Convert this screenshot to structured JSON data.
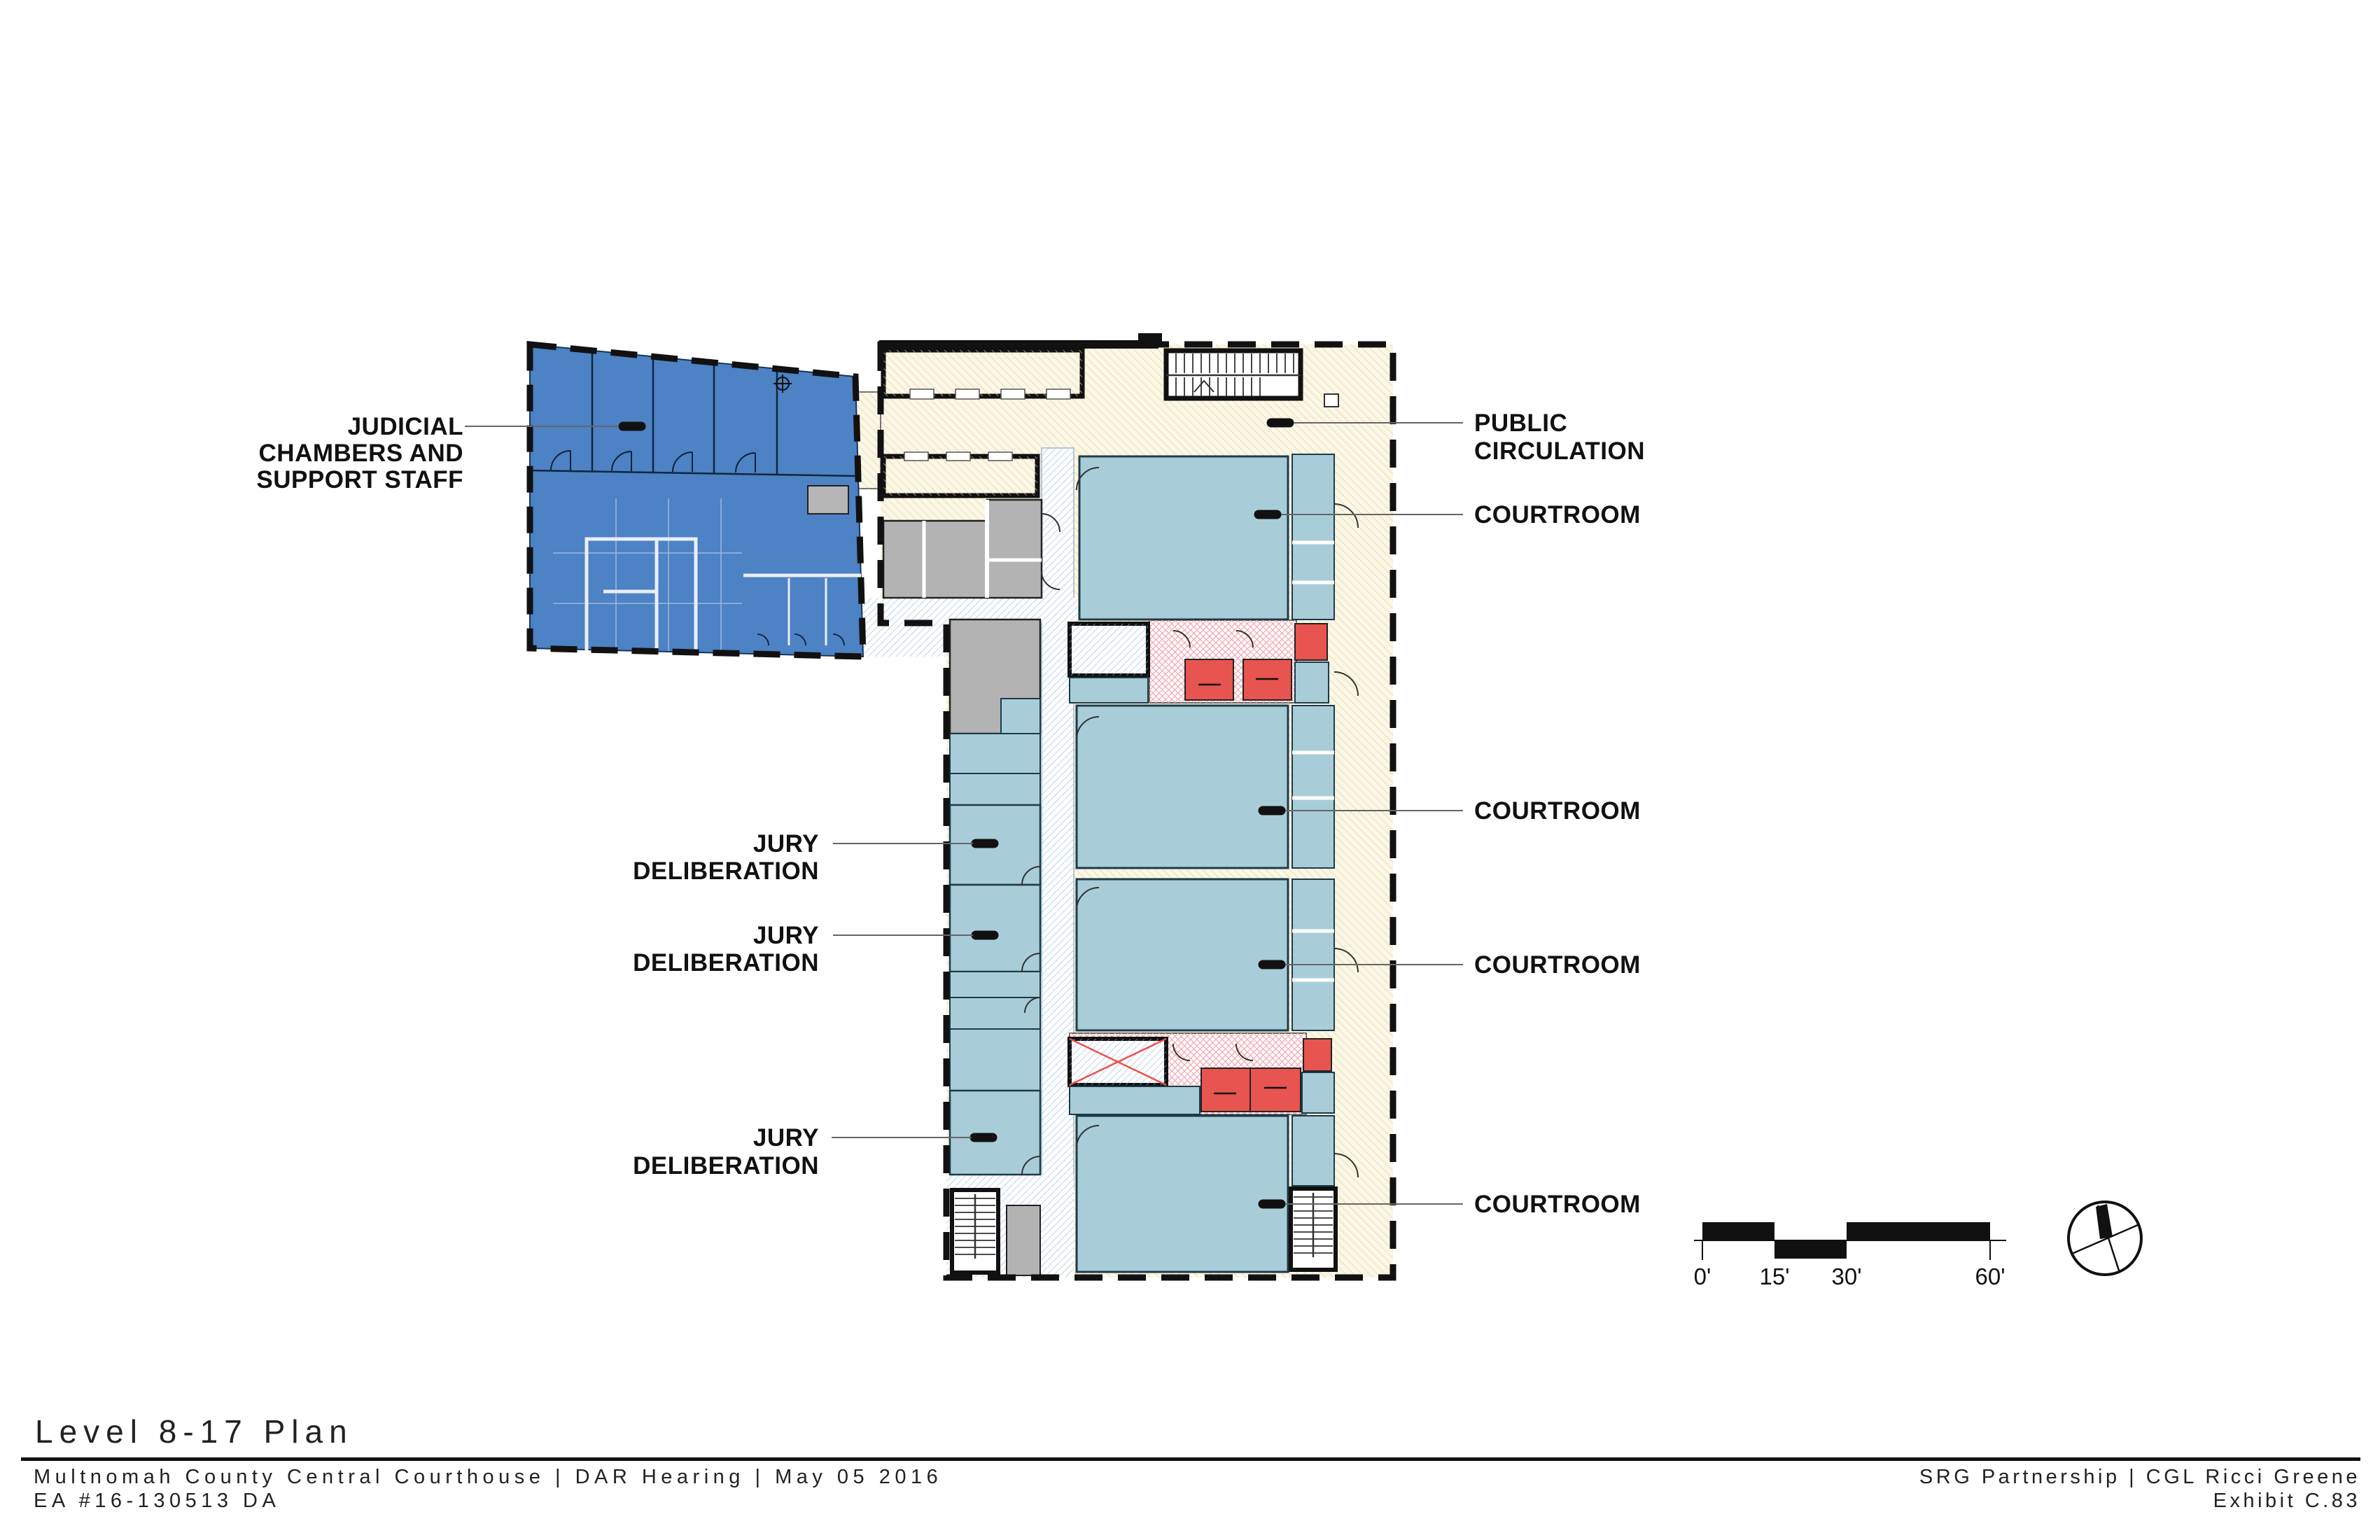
{
  "title_block": {
    "plan_title": "Level 8-17 Plan",
    "project_line": "Multnomah County Central Courthouse | DAR Hearing | May 05 2016",
    "project_number": "EA #16-130513 DA",
    "firm_line": "SRG Partnership | CGL Ricci Greene",
    "exhibit": "Exhibit C.83"
  },
  "plan_labels": {
    "judicial_chambers": [
      "JUDICIAL",
      "CHAMBERS AND",
      "SUPPORT STAFF"
    ],
    "public_circulation": [
      "PUBLIC",
      "CIRCULATION"
    ],
    "courtrooms": [
      "COURTROOM",
      "COURTROOM",
      "COURTROOM",
      "COURTROOM"
    ],
    "jury_deliberation": [
      [
        "JURY",
        "DELIBERATION"
      ],
      [
        "JURY",
        "DELIBERATION"
      ],
      [
        "JURY",
        "DELIBERATION"
      ]
    ]
  },
  "scale_bar": {
    "ticks": [
      "0'",
      "15'",
      "30'",
      "60'"
    ]
  },
  "colors": {
    "judicial_blue": "#4d82c4",
    "courtroom_blue": "#a9cdd8",
    "circulation_cream": "#fbf7e6",
    "circulation_hatch": "#dfcf97",
    "secure_corridor_hatch": "#92b6dc",
    "toilet_pink_hatch": "#f2a6b0",
    "shaft_red": "#e8544f",
    "service_gray": "#b3b3b3"
  }
}
